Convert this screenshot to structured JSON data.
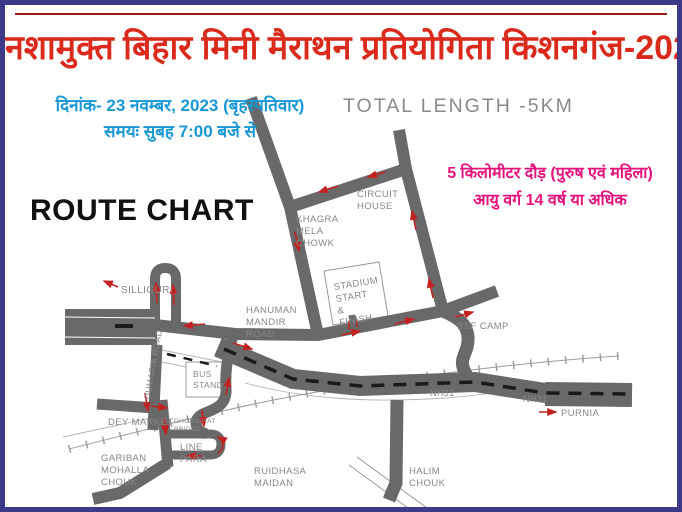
{
  "page": {
    "border_color": "#3d3a8a",
    "background": "#ffffff"
  },
  "header": {
    "title": "नशामुक्त बिहार मिनी मैराथन प्रतियोगिता  किशनगंज-2023",
    "title_color": "#d92a1c",
    "date_line": "दिनांक- 23 नवम्बर, 2023 (बृहस्पतिवार)",
    "time_line": "समयः सुबह 7:00 बजे से",
    "datetime_color": "#1898d4",
    "total_length": "TOTAL LENGTH -5KM",
    "category_line1": "5 किलोमीटर दौड़ (पुरुष एवं महिला)",
    "category_line2": "आयु  वर्ग 14 वर्ष या अधिक",
    "category_color": "#e6127d",
    "route_chart_label": "ROUTE CHART"
  },
  "map": {
    "road_color": "#696969",
    "arrow_color": "#c32222",
    "label_color": "#878787",
    "labels": {
      "silliguri": "SILLIGURI",
      "circuit_house": [
        "CIRCUIT",
        "HOUSE"
      ],
      "khagra_mela_chowk": [
        "KHAGRA",
        "MELA",
        "CHOWK"
      ],
      "stadium": [
        "STADIUM",
        "START",
        "&",
        "FINISH"
      ],
      "hanuman_mandir_road": [
        "HANUMAN",
        "MANDIR",
        "ROAD"
      ],
      "dumaria_road": "DUMARIA ROAD",
      "bsf_camp": "BSF CAMP",
      "bus_stand": [
        "BUS",
        "STAND"
      ],
      "dey_market": "DEY MARKET",
      "dhobighat_bridge": [
        "DHOBIGHAT",
        "BRIDGE"
      ],
      "line_para": [
        "LINE",
        "PARA"
      ],
      "gariban_mohalla_chouk": [
        "GARIBAN",
        "MOHALLA",
        "CHOUK"
      ],
      "ruidhasa_maidan": [
        "RUIDHASA",
        "MAIDAN"
      ],
      "halim_chouk": [
        "HALIM",
        "CHOUK"
      ],
      "nh31_west": "NH31",
      "nh31_east": "NH31",
      "purnia": "PURNIA"
    }
  }
}
